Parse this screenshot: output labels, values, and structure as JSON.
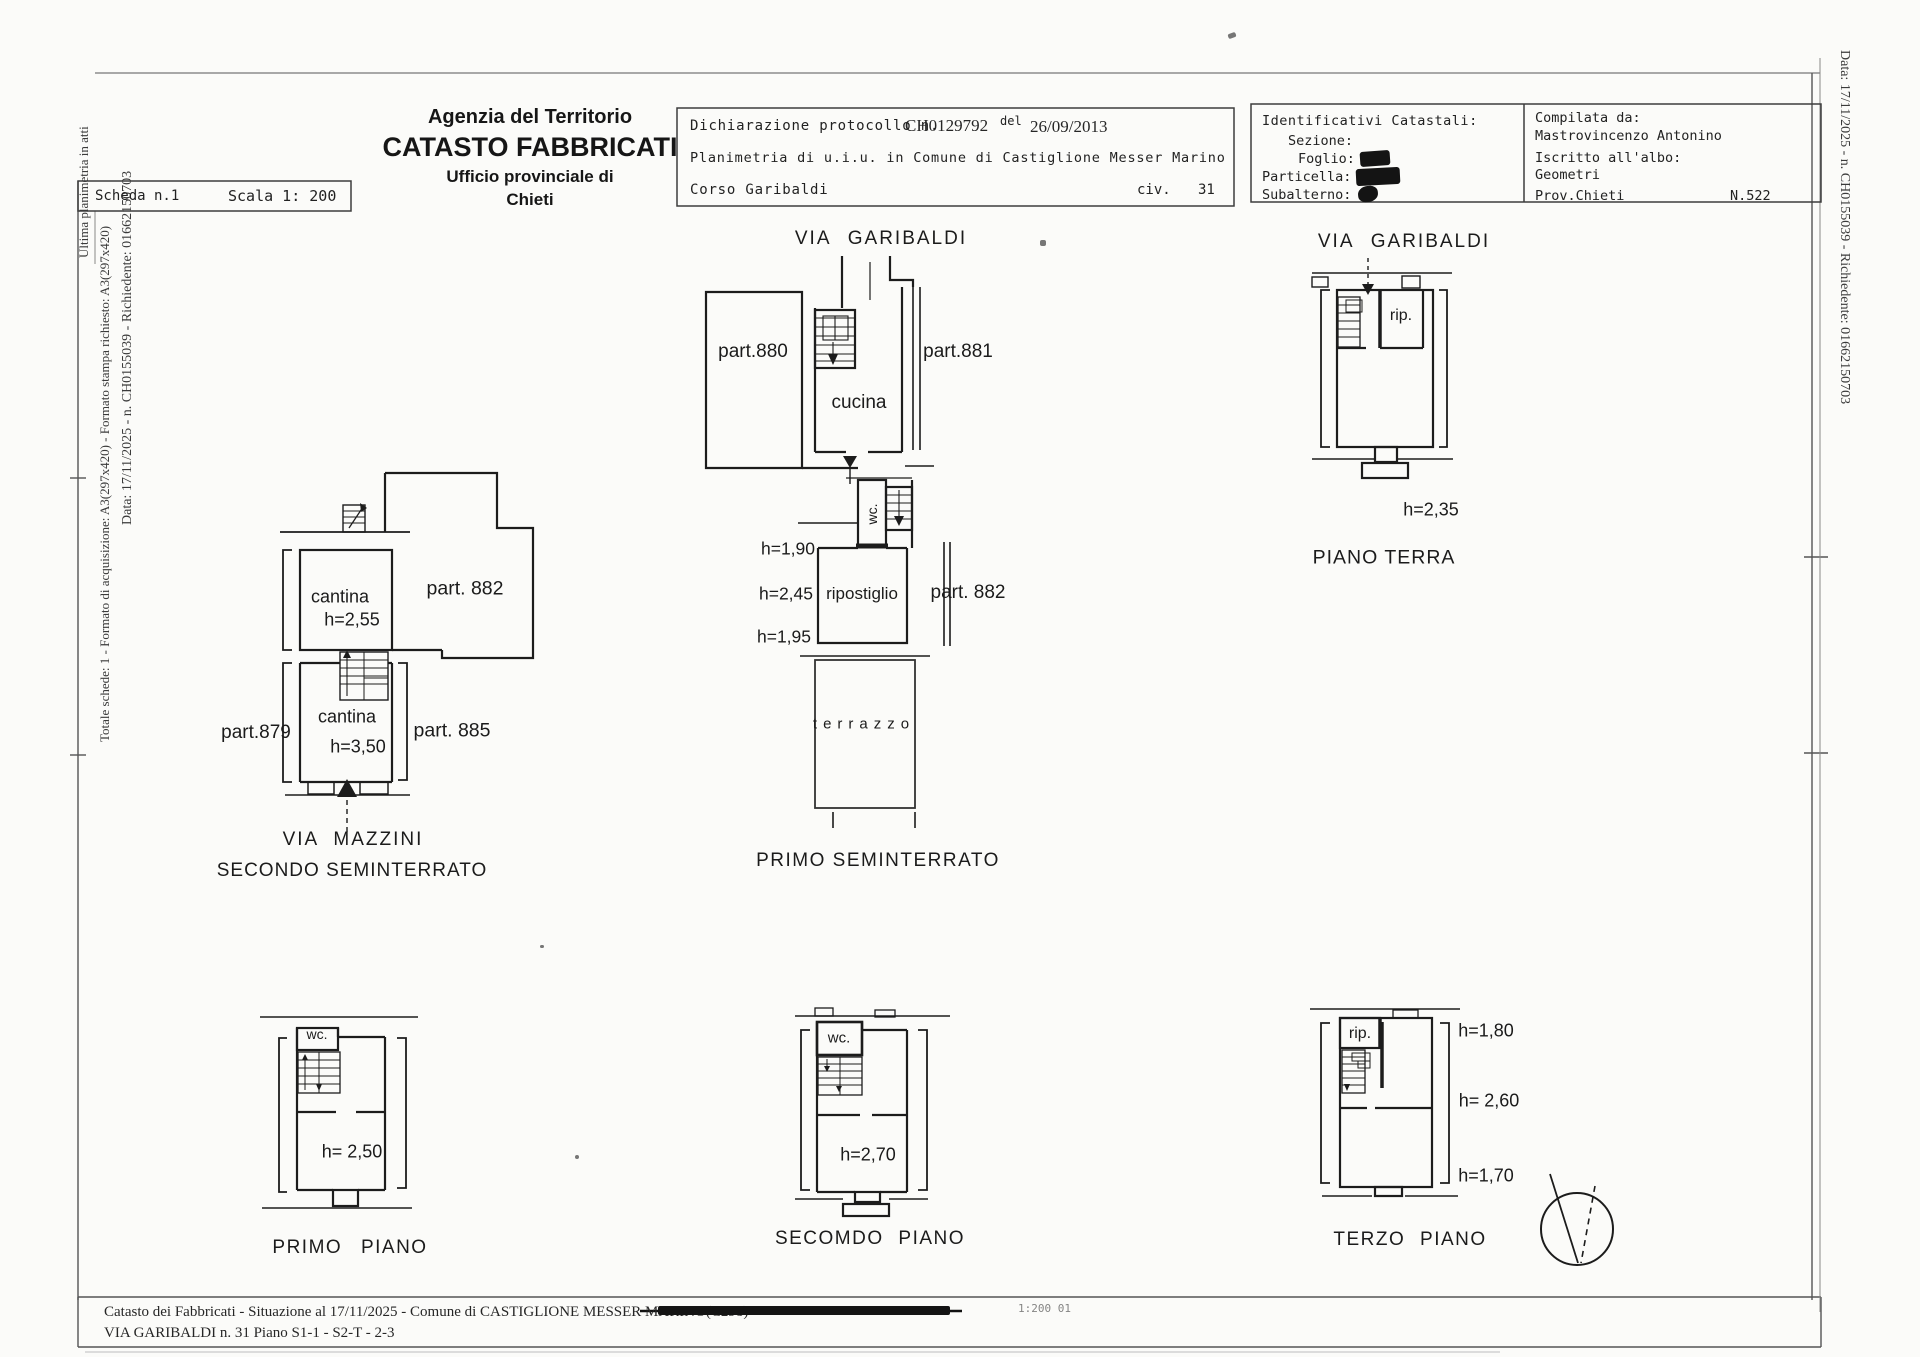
{
  "side_texts": {
    "left_line1": "Data: 17/11/2025 - n. CH0155039 - Richiedente: 01662150703",
    "left_line2": "Totale schede: 1 - Formato di acquisizione: A3(297x420) - Formato stampa richiesto: A3(297x420)",
    "left_line3": "Ultima planimetria in atti",
    "right_line": "Data: 17/11/2025 - n. CH0155039 - Richiedente: 01662150703"
  },
  "header": {
    "agency": {
      "line1": "Agenzia del Territorio",
      "line2": "CATASTO FABBRICATI",
      "line3": "Ufficio provinciale di",
      "line4": "Chieti"
    },
    "scheda_box": {
      "scheda": "Scheda n.1",
      "scala": "Scala 1: 200"
    },
    "declaration_box": {
      "line1_label": "Dichiarazione protocollo n.",
      "protocol": "CH0129792",
      "del": "del",
      "date": "26/09/2013",
      "line2": "Planimetria di u.i.u. in Comune di Castiglione Messer Marino",
      "street": "Corso Garibaldi",
      "civ_label": "civ.",
      "civ_value": "31"
    },
    "cadastral_box": {
      "title": "Identificativi Catastali:",
      "sezione_label": "Sezione:",
      "foglio_label": "Foglio:",
      "particella_label": "Particella:",
      "subalterno_label": "Subalterno:"
    },
    "compiler_box": {
      "title": "Compilata da:",
      "name": "Mastrovincenzo Antonino",
      "albo_label": "Iscritto all'albo:",
      "albo": "Geometri",
      "prov": "Prov.Chieti",
      "number": "N.522"
    }
  },
  "plans": {
    "primo_seminterrato": {
      "street": "VIA GARIBALDI",
      "part_880": "part.880",
      "part_881": "part.881",
      "cucina": "cucina",
      "wc": "wc.",
      "h1": "h=1,90",
      "h2": "h=2,45",
      "h3": "h=1,95",
      "ripostiglio": "ripostiglio",
      "part_882": "part. 882",
      "terrazzo": "terrazzo",
      "title": "PRIMO SEMINTERRATO"
    },
    "piano_terra": {
      "street": "VIA GARIBALDI",
      "rip": "rip.",
      "h": "h=2,35",
      "title": "PIANO TERRA"
    },
    "secondo_seminterrato": {
      "cantina1": "cantina",
      "cantina1_h": "h=2,55",
      "part_882": "part. 882",
      "cantina2": "cantina",
      "cantina2_h": "h=3,50",
      "part_879": "part.879",
      "part_885": "part. 885",
      "street": "VIA MAZZINI",
      "title": "SECONDO SEMINTERRATO"
    },
    "primo_piano": {
      "wc": "wc.",
      "h": "h= 2,50",
      "title": "PRIMO PIANO"
    },
    "secondo_piano": {
      "wc": "wc.",
      "h": "h=2,70",
      "title": "SECOMDO PIANO"
    },
    "terzo_piano": {
      "rip": "rip.",
      "h1": "h=1,80",
      "h2": "h= 2,60",
      "h3": "h=1,70",
      "title": "TERZO PIANO"
    }
  },
  "footer": {
    "line1_prefix": "Catasto dei Fabbricati - Situazione al 17/11/2025 - Comune di CASTIGLIONE MESSER MARINO(C298) - <",
    "line2": "VIA GARIBALDI n. 31 Piano S1-1 - S2-T - 2-3",
    "page_note": "1:200 01"
  },
  "colors": {
    "ink": "#1c1c1c",
    "line": "#2b2b2b",
    "redaction": "#111111"
  }
}
